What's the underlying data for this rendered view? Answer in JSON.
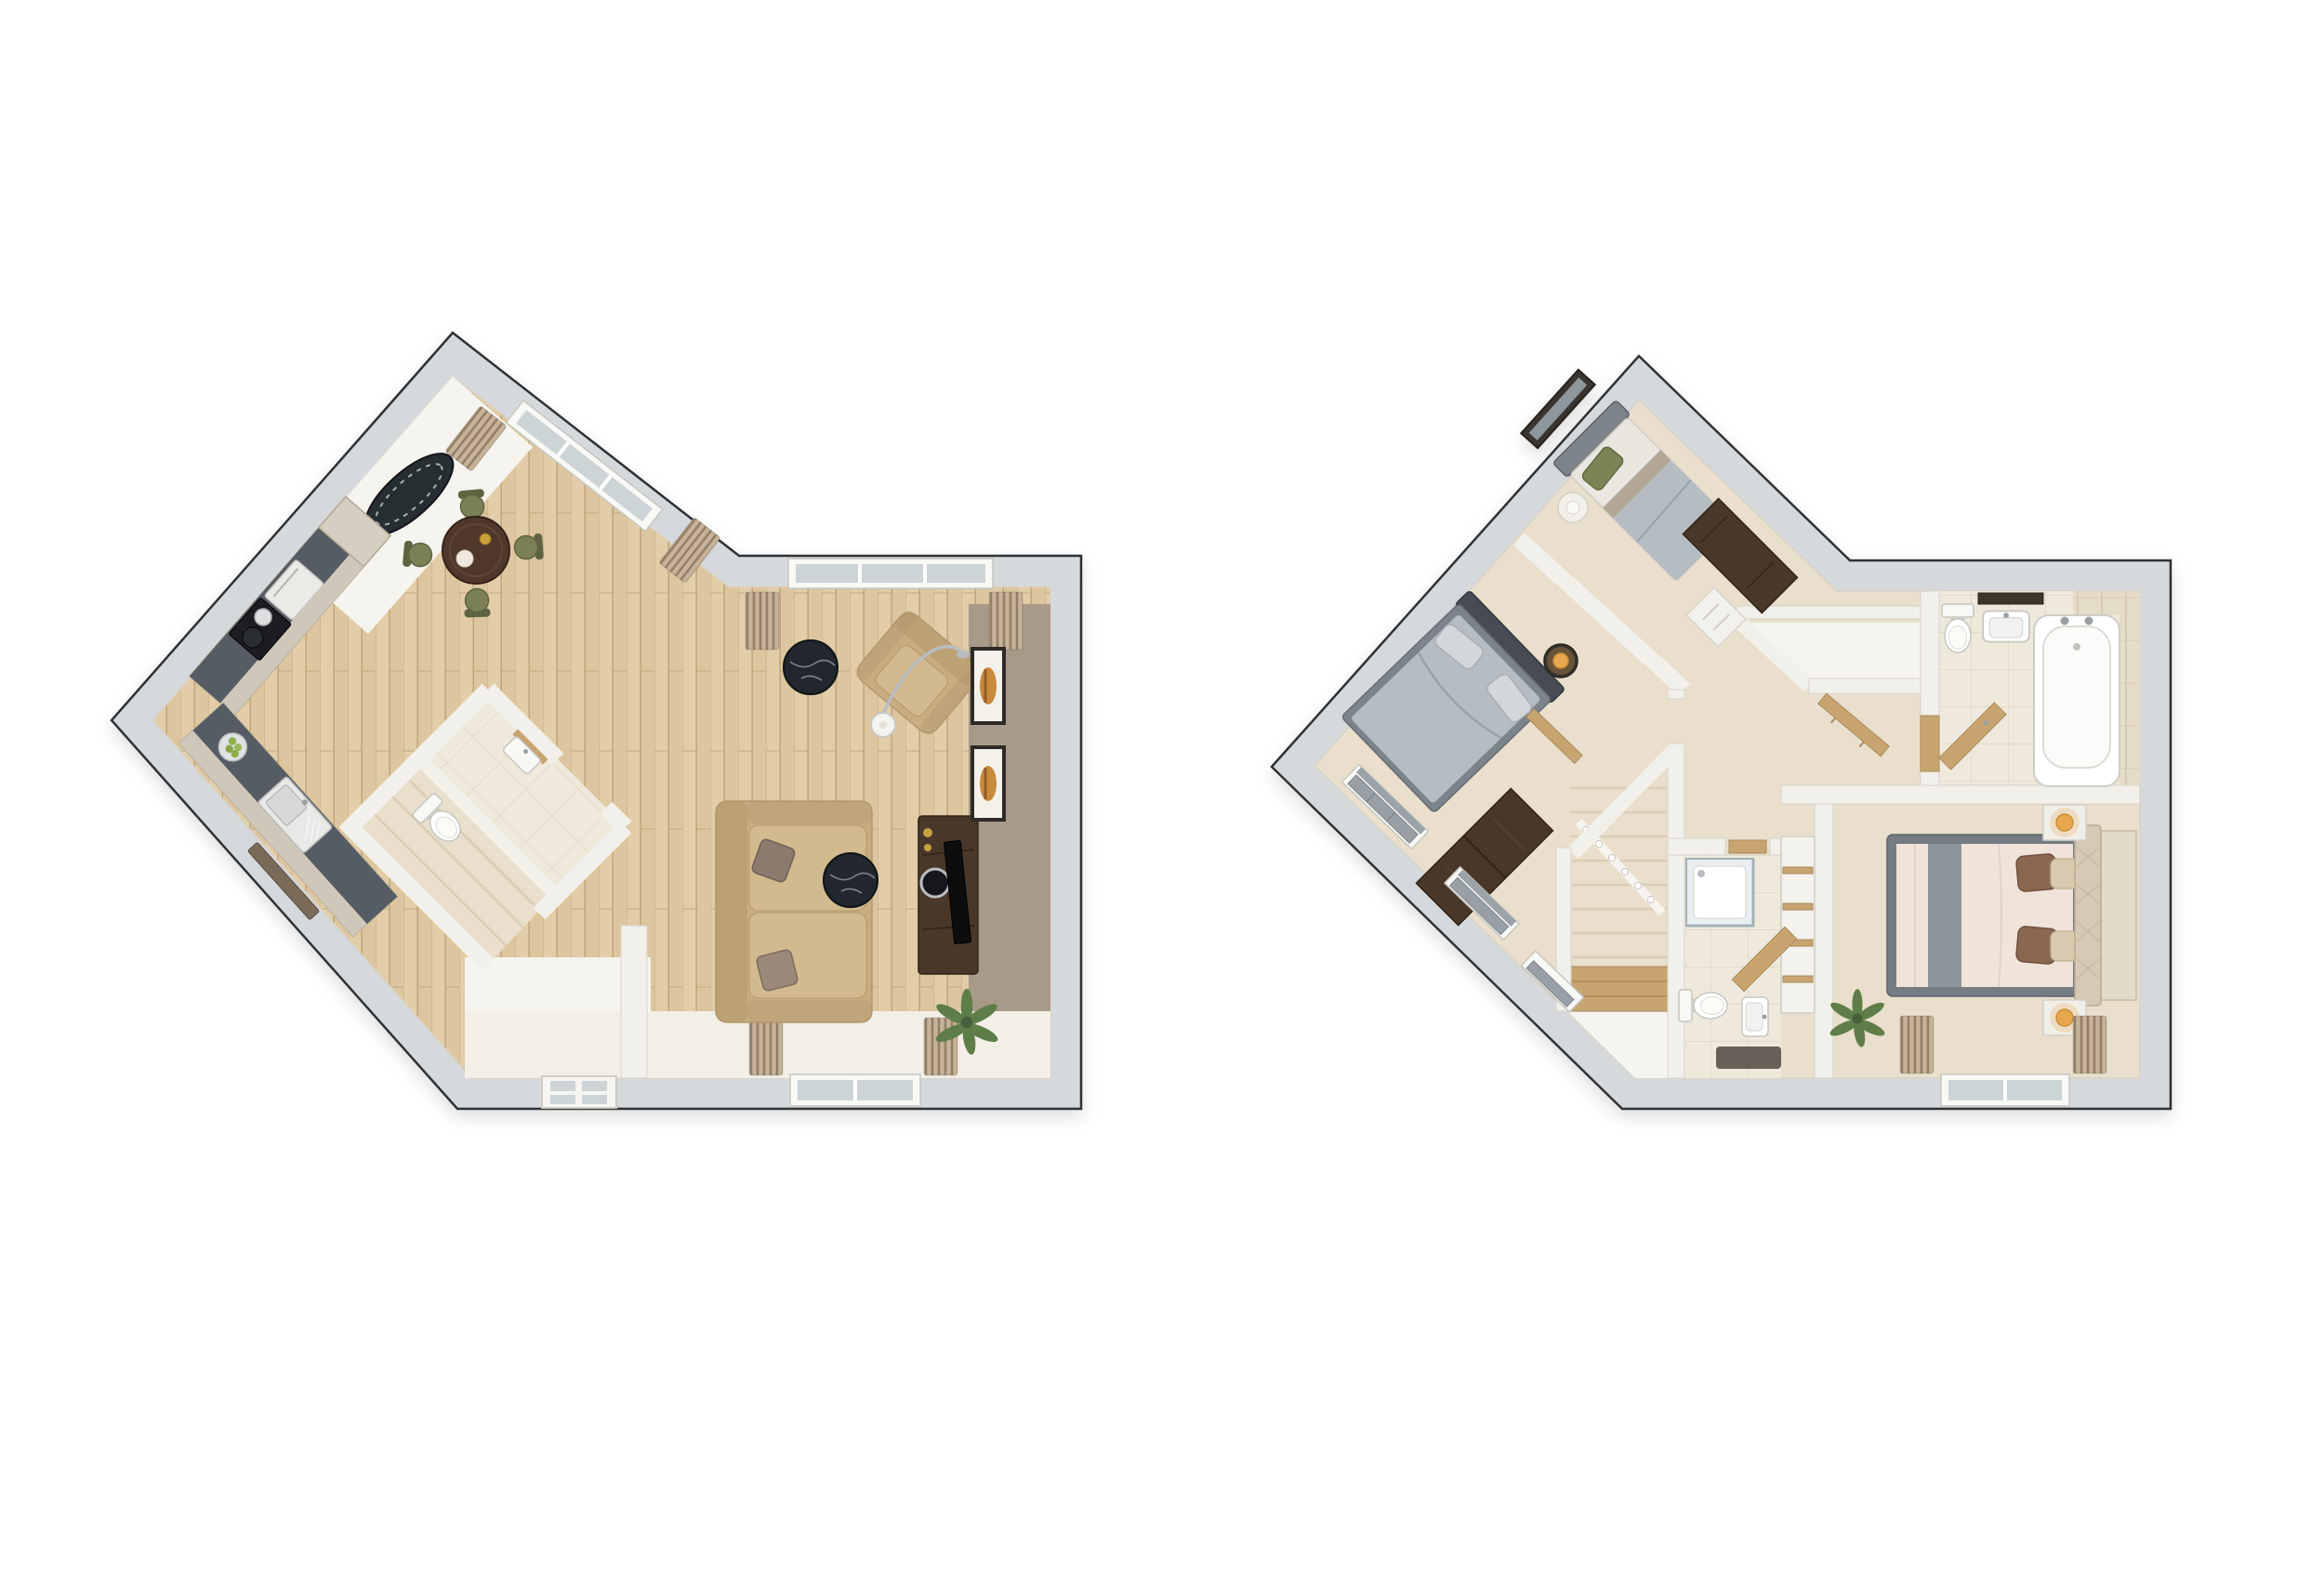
{
  "title": "Two-storey 3D floor plan pair",
  "palette": {
    "wall": "#d6d9dc",
    "wall_line": "#2f3134",
    "innerwall": "#f2f0ea",
    "innerwall_line": "#d8d4cb",
    "white_floor": "#f6f4ee",
    "pale_band": "#f3efe7",
    "wood": "#e2cda8",
    "wood2": "#d8c097",
    "wood_line": "#c2a67c",
    "carpet": "#e9dfcc",
    "carpet_line": "#d9cdb4",
    "tile": "#efe9db",
    "tile_line": "#ded6c3",
    "taupe": "#a89a88",
    "counter_top": "#565c63",
    "cabinet": "#c9c0b2",
    "cabinet_line": "#b2a995",
    "cabinet_face": "#cfc7b9",
    "steel": "#b9bdc1",
    "dark_fixture": "#1d1f21",
    "tan": "#c7ad80",
    "tan_dark": "#b2976c",
    "tan_light": "#d2ba8e",
    "olive": "#7c8055",
    "olive_dark": "#5f6340",
    "wood_furn": "#4a3729",
    "wood_furn_line": "#2f2318",
    "marble": "#24282d",
    "marble_vein": "#c9ced3",
    "grey_bed": "#b5bcc2",
    "grey_bed_dark": "#7c838a",
    "headboard_dark": "#474c52",
    "bed_white": "#eae7e1",
    "green_pillow": "#7c8354",
    "master_cream": "#f0e3da",
    "runner_grey": "#8d949c",
    "pillow_brown": "#8a6750",
    "pillow_cream": "#d9c9ae",
    "headboard_cream": "#d6c9b6",
    "rug": "#e3dac9",
    "lamp": "#e8a74e",
    "plant": "#5f7d4a",
    "plant_dark": "#46603a",
    "pot": "#b9ab97",
    "curtain": "#c6b398",
    "curtain_dark": "#937f67",
    "radiator": "#98a0a6",
    "fixture_white": "#f8f8f5",
    "fixture_line": "#c6c6c0",
    "wood_light": "#c8a470",
    "glass": "#ccd4d6",
    "glass_line": "#9fb0b8",
    "shower": "#e9eef0",
    "mat_dark": "#5a544c",
    "frame_dark": "#2e2a26",
    "art": "#c98a3a",
    "window_dark": "#3a3631"
  },
  "floors": [
    {
      "id": "ground-floor",
      "position": "left",
      "rooms": [
        {
          "name": "kitchen",
          "furniture": [
            "kitchen-counter",
            "hob",
            "oven",
            "sink",
            "fruit-bowl",
            "radiator",
            "tall-cabinet"
          ]
        },
        {
          "name": "dining-area",
          "furniture": [
            "dining-table",
            "dining-chairs",
            "oval-rug",
            "window",
            "curtains"
          ]
        },
        {
          "name": "living-room",
          "furniture": [
            "sofa",
            "armchair",
            "floor-lamp",
            "coffee-table",
            "coffee-table",
            "tv-unit",
            "tv",
            "wall-art",
            "plant",
            "feature-wall",
            "window",
            "curtains"
          ]
        },
        {
          "name": "wc",
          "furniture": [
            "toilet",
            "basin"
          ]
        },
        {
          "name": "hall",
          "furniture": [
            "front-door"
          ]
        },
        {
          "name": "stairs",
          "furniture": [
            "balustrade"
          ]
        }
      ]
    },
    {
      "id": "first-floor",
      "position": "right",
      "rooms": [
        {
          "name": "bedroom-1",
          "furniture": [
            "double-bed",
            "bedside-table",
            "table-lamp",
            "dresser",
            "radiator-window",
            "radiator-window"
          ]
        },
        {
          "name": "bedroom-2",
          "furniture": [
            "single-bed",
            "bedside-table",
            "desk",
            "chest-of-drawers",
            "window"
          ]
        },
        {
          "name": "bathroom",
          "furniture": [
            "bath",
            "wash-basin",
            "toilet",
            "vanity-shelf",
            "tiled-wall",
            "shelf"
          ]
        },
        {
          "name": "en-suite",
          "furniture": [
            "shower",
            "toilet",
            "wash-basin",
            "bath-mat",
            "vanity-shelf"
          ]
        },
        {
          "name": "landing",
          "furniture": [
            "stairs",
            "balustrade",
            "storage-alcove",
            "airing-shelves",
            "wood-shelf",
            "radiator-window"
          ]
        },
        {
          "name": "master-bedroom",
          "furniture": [
            "double-bed",
            "nightstand",
            "nightstand",
            "table-lamp",
            "table-lamp",
            "rug",
            "plant",
            "window",
            "curtains"
          ]
        }
      ]
    }
  ]
}
